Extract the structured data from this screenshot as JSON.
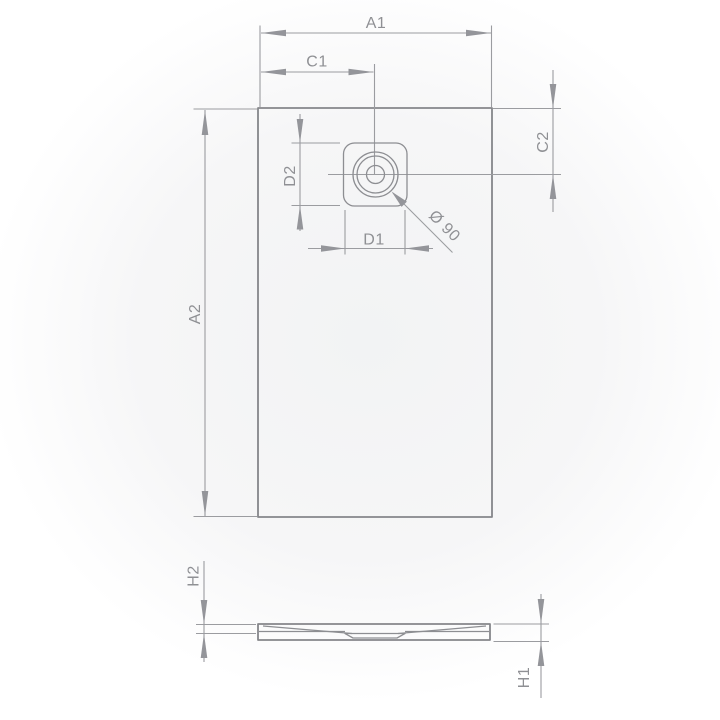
{
  "drawing": {
    "type": "technical-dimension-diagram",
    "subject": "rectangular shower tray with offset round drain — plan view and side profile",
    "views": {
      "plan": "top view with drain position dimensions",
      "profile": "side section view with height dimensions"
    },
    "labels": {
      "a1": "A1",
      "c1": "C1",
      "c2": "C2",
      "d1": "D1",
      "d2": "D2",
      "a2": "A2",
      "h1": "H1",
      "h2": "H2",
      "drain_diameter": "Ø 90"
    },
    "colors": {
      "background_center": "#f2f3f4",
      "background_edge": "#ffffff",
      "object_line": "#85868a",
      "dimension_line": "#9b9ca0",
      "arrow_fill": "#94959a",
      "text": "#8f9094"
    }
  }
}
